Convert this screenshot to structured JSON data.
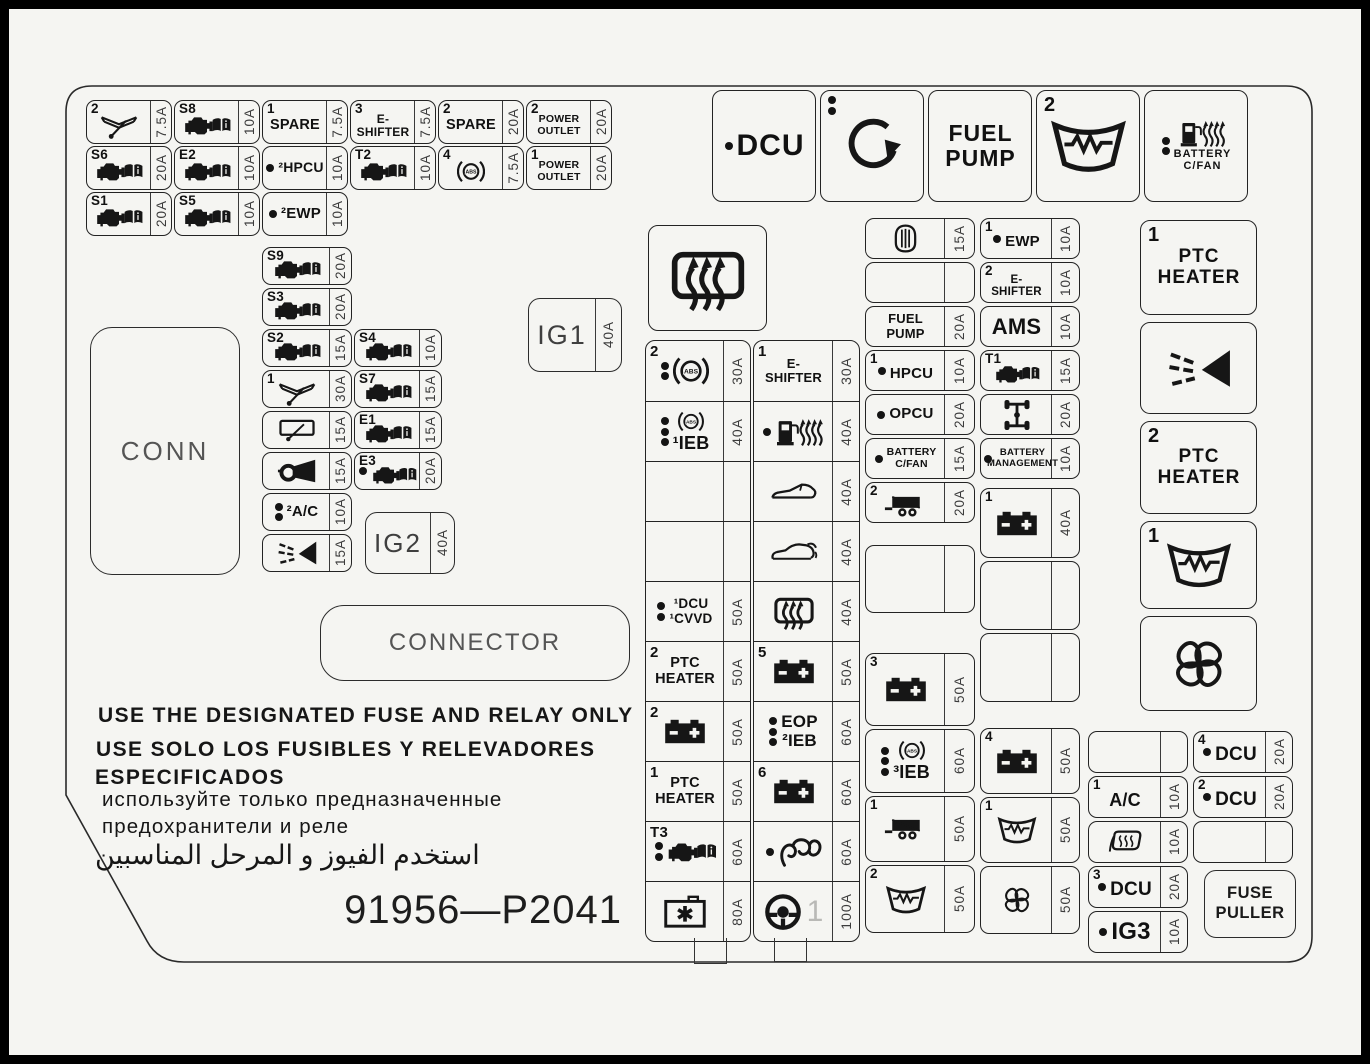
{
  "panel": {
    "part_number": "91956—P2041",
    "warnings": {
      "en": "USE THE DESIGNATED FUSE AND RELAY ONLY",
      "es1": "USE SOLO LOS FUSIBLES Y RELEVADORES",
      "es2": "ESPECIFICADOS",
      "ru1": "используйте только предназначенные",
      "ru2": "предохранители и реле",
      "ar": "استخدم الفيوز و المرحل المناسبين"
    },
    "conn_label": "CONN",
    "connector_label": "CONNECTOR",
    "ig1": {
      "label": "IG1",
      "amp": "40A"
    },
    "ig2": {
      "label": "IG2",
      "amp": "40A"
    },
    "fuse_puller": {
      "line1": "FUSE",
      "line2": "PULLER"
    }
  },
  "colors": {
    "panel_bg": "#f5f5f2",
    "line": "#1c1c1c",
    "frame": "#000000"
  },
  "grid_topleft": [
    {
      "corner": "2",
      "icon": "wiper",
      "scale": 0.95,
      "amp": "7.5A"
    },
    {
      "corner": "S8",
      "icon": "engine-book",
      "scale": 0.92,
      "amp": "10A"
    },
    {
      "corner": "1",
      "label": "SPARE",
      "fs": 14.5,
      "amp": "7.5A"
    },
    {
      "corner": "3",
      "label": "E-\nSHIFTER",
      "fs": 12,
      "amp": "7.5A"
    },
    {
      "corner": "2",
      "label": "SPARE",
      "fs": 14.5,
      "amp": "20A"
    },
    {
      "corner": "2",
      "label": "POWER\nOUTLET",
      "fs": 10.5,
      "amp": "20A"
    },
    {
      "corner": "S6",
      "icon": "engine-book",
      "scale": 0.92,
      "amp": "20A"
    },
    {
      "corner": "E2",
      "icon": "engine-book",
      "scale": 0.92,
      "amp": "10A"
    },
    {
      "dots": 1,
      "label": "²HPCU",
      "fs": 14,
      "amp": "10A"
    },
    {
      "corner": "T2",
      "icon": "engine-book",
      "scale": 0.92,
      "amp": "10A"
    },
    {
      "corner": "4",
      "icon": "abs",
      "scale": 0.78,
      "amp": "7.5A"
    },
    {
      "corner": "1",
      "label": "POWER\nOUTLET",
      "fs": 10.5,
      "amp": "20A"
    },
    {
      "corner": "S1",
      "icon": "engine-book",
      "scale": 0.92,
      "amp": "20A"
    },
    {
      "corner": "S5",
      "icon": "engine-book",
      "scale": 0.92,
      "amp": "10A"
    },
    {
      "dots": 1,
      "label": "²EWP",
      "fs": 15,
      "amp": "10A"
    },
    null,
    null,
    null
  ],
  "left_col_a": [
    {
      "corner": "S9",
      "icon": "engine-book",
      "scale": 0.92,
      "amp": "20A"
    },
    {
      "corner": "S3",
      "icon": "engine-book",
      "scale": 0.92,
      "amp": "20A"
    },
    {
      "corner": "S2",
      "icon": "engine-book",
      "scale": 0.92,
      "amp": "15A"
    },
    {
      "corner": "1",
      "icon": "wiper",
      "scale": 0.95,
      "amp": "30A"
    },
    {
      "icon": "rear-wiper",
      "scale": 0.95,
      "amp": "15A"
    },
    {
      "icon": "horn",
      "scale": 0.95,
      "amp": "15A"
    },
    {
      "dots": 2,
      "label": "²A/C",
      "fs": 15,
      "amp": "10A"
    },
    {
      "icon": "washer-spray",
      "scale": 0.95,
      "amp": "15A"
    }
  ],
  "left_col_b": [
    {
      "corner": "S4",
      "icon": "engine-book",
      "scale": 0.92,
      "amp": "10A"
    },
    {
      "corner": "S7",
      "icon": "engine-book",
      "scale": 0.92,
      "amp": "15A"
    },
    {
      "corner": "E1",
      "icon": "engine-book",
      "scale": 0.92,
      "amp": "15A"
    },
    {
      "corner": "E3",
      "dots": 1,
      "icon": "engine-book",
      "scale": 0.88,
      "amp": "20A"
    }
  ],
  "mid_grid_left": [
    {
      "corner": "2",
      "dots": 2,
      "icon": "abs",
      "amp": "30A"
    },
    {
      "dots": 3,
      "icon": "abs",
      "scale": 0.72,
      "label": "¹IEB",
      "fs": 18,
      "amp": "40A"
    },
    {
      "empty": true,
      "amp": ""
    },
    {
      "empty": true,
      "amp": ""
    },
    {
      "dots": 2,
      "label": "¹DCU\n¹CVVD",
      "fs": 13.5,
      "amp": "50A"
    },
    {
      "corner": "2",
      "label": "PTC\nHEATER",
      "fs": 14.5,
      "amp": "50A"
    },
    {
      "corner": "2",
      "icon": "battery",
      "amp": "50A"
    },
    {
      "corner": "1",
      "label": "PTC\nHEATER",
      "fs": 14.5,
      "amp": "50A"
    },
    {
      "corner": "T3",
      "dots": 2,
      "icon": "engine-book",
      "scale": 0.95,
      "amp": "60A"
    },
    {
      "icon": "junction-box",
      "amp": "80A"
    }
  ],
  "mid_grid_right": [
    {
      "corner": "1",
      "label": "E-\nSHIFTER",
      "fs": 13,
      "amp": "30A"
    },
    {
      "dots": 1,
      "icon": "fuel-heat",
      "scale": 0.95,
      "amp": "40A"
    },
    {
      "icon": "convertible-car",
      "scale": 0.95,
      "amp": "40A"
    },
    {
      "icon": "hatch-car",
      "scale": 0.95,
      "amp": "40A"
    },
    {
      "icon": "rear-defrost",
      "amp": "40A"
    },
    {
      "corner": "5",
      "icon": "battery",
      "amp": "50A"
    },
    {
      "dots": 3,
      "label": "EOP\n²IEB",
      "fs": 17,
      "amp": "60A"
    },
    {
      "corner": "6",
      "icon": "battery",
      "amp": "60A"
    },
    {
      "dots": 1,
      "icon": "glow-coil",
      "scale": 0.95,
      "amp": "60A"
    },
    {
      "icon": "steering-wheel",
      "ghost": "1",
      "amp": "100A"
    }
  ],
  "col_a1": [
    {
      "icon": "airbag",
      "scale": 0.95,
      "amp": "15A"
    },
    {
      "empty": true,
      "amp": ""
    },
    {
      "label": "FUEL\nPUMP",
      "fs": 13,
      "amp": "20A"
    },
    {
      "corner": "1",
      "dots": 1,
      "label": "HPCU",
      "fs": 15,
      "amp": "10A"
    },
    {
      "dots": 1,
      "label": "OPCU",
      "fs": 15,
      "amp": "20A"
    },
    {
      "dots": 1,
      "label": "BATTERY\nC/FAN",
      "fs": 10.5,
      "amp": "15A"
    },
    {
      "corner": "2",
      "icon": "trailer",
      "amp": "20A"
    }
  ],
  "col_a_empty": [
    {
      "empty": true,
      "amp": ""
    }
  ],
  "col_a2": [
    {
      "corner": "3",
      "icon": "battery",
      "amp": "50A"
    },
    {
      "dots": 3,
      "icon": "abs",
      "scale": 0.72,
      "label": "³IEB",
      "fs": 18,
      "amp": "60A"
    },
    {
      "corner": "1",
      "icon": "trailer",
      "amp": "50A"
    },
    {
      "corner": "2",
      "icon": "heated-windshield",
      "scale": 0.95,
      "amp": "50A"
    }
  ],
  "col_b1": [
    {
      "corner": "1",
      "dots": 1,
      "label": "EWP",
      "fs": 15,
      "amp": "10A"
    },
    {
      "corner": "2",
      "label": "E-\nSHIFTER",
      "fs": 11.5,
      "amp": "10A"
    },
    {
      "label": "AMS",
      "fs": 22,
      "amp": "10A"
    },
    {
      "corner": "T1",
      "icon": "engine-book",
      "scale": 0.88,
      "amp": "15A"
    },
    {
      "icon": "driveline",
      "scale": 0.95,
      "amp": "20A"
    },
    {
      "dots": 1,
      "label": "BATTERY\nMANAGEMENT",
      "fs": 9.5,
      "amp": "10A"
    }
  ],
  "col_b_mid": [
    {
      "corner": "1",
      "icon": "battery",
      "amp": "40A"
    },
    {
      "empty": true,
      "amp": ""
    },
    {
      "empty": true,
      "amp": ""
    }
  ],
  "col_b2": [
    {
      "corner": "4",
      "icon": "battery",
      "amp": "50A"
    },
    {
      "corner": "1",
      "icon": "heated-windshield",
      "scale": 0.9,
      "amp": "50A"
    },
    {
      "icon": "fan",
      "scale": 0.85,
      "amp": "50A"
    }
  ],
  "relays_top": [
    {
      "dots": 1,
      "label": "DCU",
      "fs": 30
    },
    {
      "dots_tl": 2,
      "icon": "circular-arrow"
    },
    {
      "label": "FUEL\nPUMP",
      "fs": 23
    },
    {
      "corner": "2",
      "icon": "heated-windshield",
      "scale": 1.75
    },
    {
      "dots": 2,
      "icon": "fuel-heat",
      "scale": 0.9,
      "label": "BATTERY\nC/FAN",
      "fs": 11
    }
  ],
  "defrost_relay": [
    {
      "icon": "rear-defrost",
      "scale": 1.85
    }
  ],
  "right_relays": [
    {
      "corner": "1",
      "label": "PTC\nHEATER",
      "fs": 19
    },
    {
      "icon": "washer-spray",
      "scale": 1.55
    },
    {
      "corner": "2",
      "label": "PTC\nHEATER",
      "fs": 19
    },
    {
      "corner": "1",
      "icon": "heated-windshield",
      "scale": 1.5
    },
    {
      "icon": "fan",
      "scale": 1.6
    }
  ],
  "br_left": [
    {
      "empty": true,
      "amp": ""
    },
    {
      "corner": "1",
      "label": "A/C",
      "fs": 18,
      "amp": "10A"
    },
    {
      "icon": "heated-mirror",
      "scale": 0.9,
      "amp": "10A"
    },
    {
      "corner": "3",
      "dots": 1,
      "label": "DCU",
      "fs": 19,
      "amp": "20A"
    },
    {
      "dots": 1,
      "label": "IG3",
      "fs": 24,
      "amp": "10A"
    }
  ],
  "br_right": [
    {
      "corner": "4",
      "dots": 1,
      "label": "DCU",
      "fs": 19,
      "amp": "20A"
    },
    {
      "corner": "2",
      "dots": 1,
      "label": "DCU",
      "fs": 19,
      "amp": "20A"
    },
    {
      "empty": true,
      "amp": ""
    }
  ]
}
